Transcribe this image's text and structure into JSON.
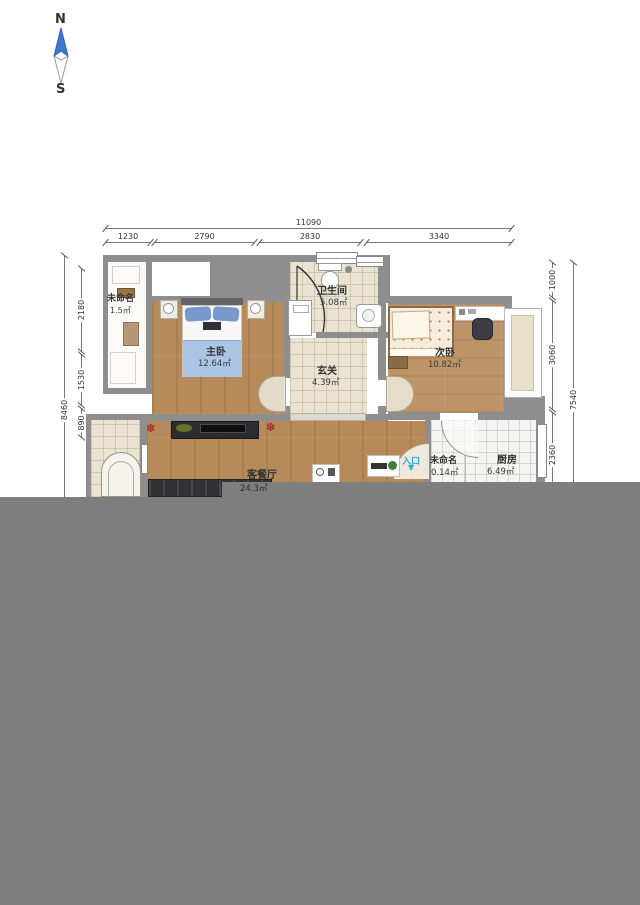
{
  "compass": {
    "north": "N",
    "south": "S"
  },
  "dimensions": {
    "top_total": "11090",
    "top_segments": [
      "1230",
      "2790",
      "2830",
      "3340"
    ],
    "left_total": "8460",
    "left_segments": [
      "2180",
      "1530",
      "890"
    ],
    "right_total": "7540",
    "right_segments": [
      "1000",
      "3060",
      "2360"
    ]
  },
  "rooms": {
    "closet": {
      "name": "未命名",
      "area": "1.5㎡"
    },
    "master_bedroom": {
      "name": "主卧",
      "area": "12.64㎡"
    },
    "bathroom": {
      "name": "卫生间",
      "area": "5.08㎡"
    },
    "hallway": {
      "name": "玄关",
      "area": "4.39㎡"
    },
    "second_bedroom": {
      "name": "次卧",
      "area": "10.82㎡"
    },
    "living_dining": {
      "name": "客餐厅",
      "area": "24.3㎡"
    },
    "small_unnamed": {
      "name": "未命名",
      "area": "0.14㎡"
    },
    "kitchen": {
      "name": "厨房",
      "area": "6.49㎡"
    }
  },
  "entrance": {
    "label": "入口",
    "arrow": "▼"
  },
  "colors": {
    "entrance_blue": "#2ba8dc",
    "overlay_gray": "#7e7e7e",
    "wall_gray": "#8e8e8e",
    "bed_blue": "#aac6e4"
  }
}
